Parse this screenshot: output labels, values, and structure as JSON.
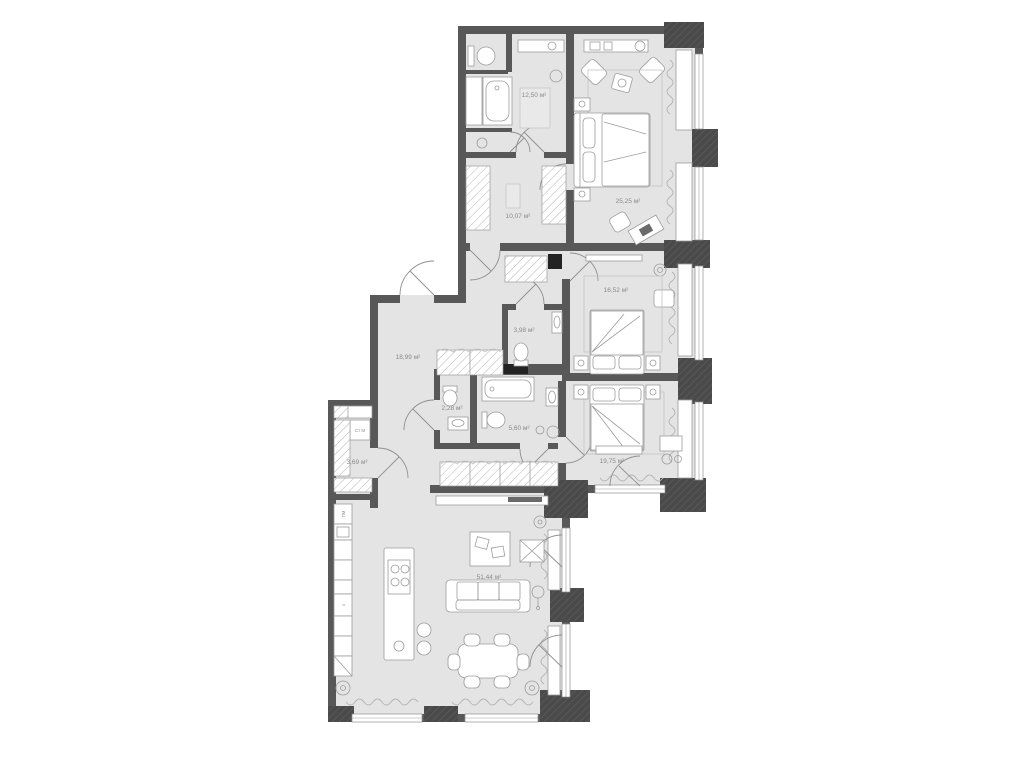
{
  "plan": {
    "type": "apartment-floor-plan",
    "area_unit": "м²",
    "rooms": {
      "bathroom_main": {
        "area_label": "12,50 м²"
      },
      "master_bedroom": {
        "area_label": "25,25 м²"
      },
      "wardrobe": {
        "area_label": "10,07 м²"
      },
      "bedroom_middle": {
        "area_label": "16,52 м²"
      },
      "wc_small": {
        "area_label": "3,98 м²"
      },
      "hallway": {
        "area_label": "18,99 м²"
      },
      "wc_guest": {
        "area_label": "2,28 м²"
      },
      "bathroom_second": {
        "area_label": "5,60 м²"
      },
      "bedroom_lower": {
        "area_label": "19,75 м²"
      },
      "laundry_closet": {
        "area_label": "3,69 м²"
      },
      "living_kitchen": {
        "area_label": "51,44 м²"
      }
    },
    "appliances": {
      "washing_machine": "Ст М",
      "dishwasher": "ПМ",
      "fridge": "х"
    },
    "colors": {
      "background": "#ffffff",
      "floor": "#e4e4e4",
      "wall": "#585858",
      "column": "#4a4a4a",
      "furniture_stroke": "#9c9c9c",
      "label_text": "#8a8a8a",
      "shaft": "#232323"
    }
  }
}
